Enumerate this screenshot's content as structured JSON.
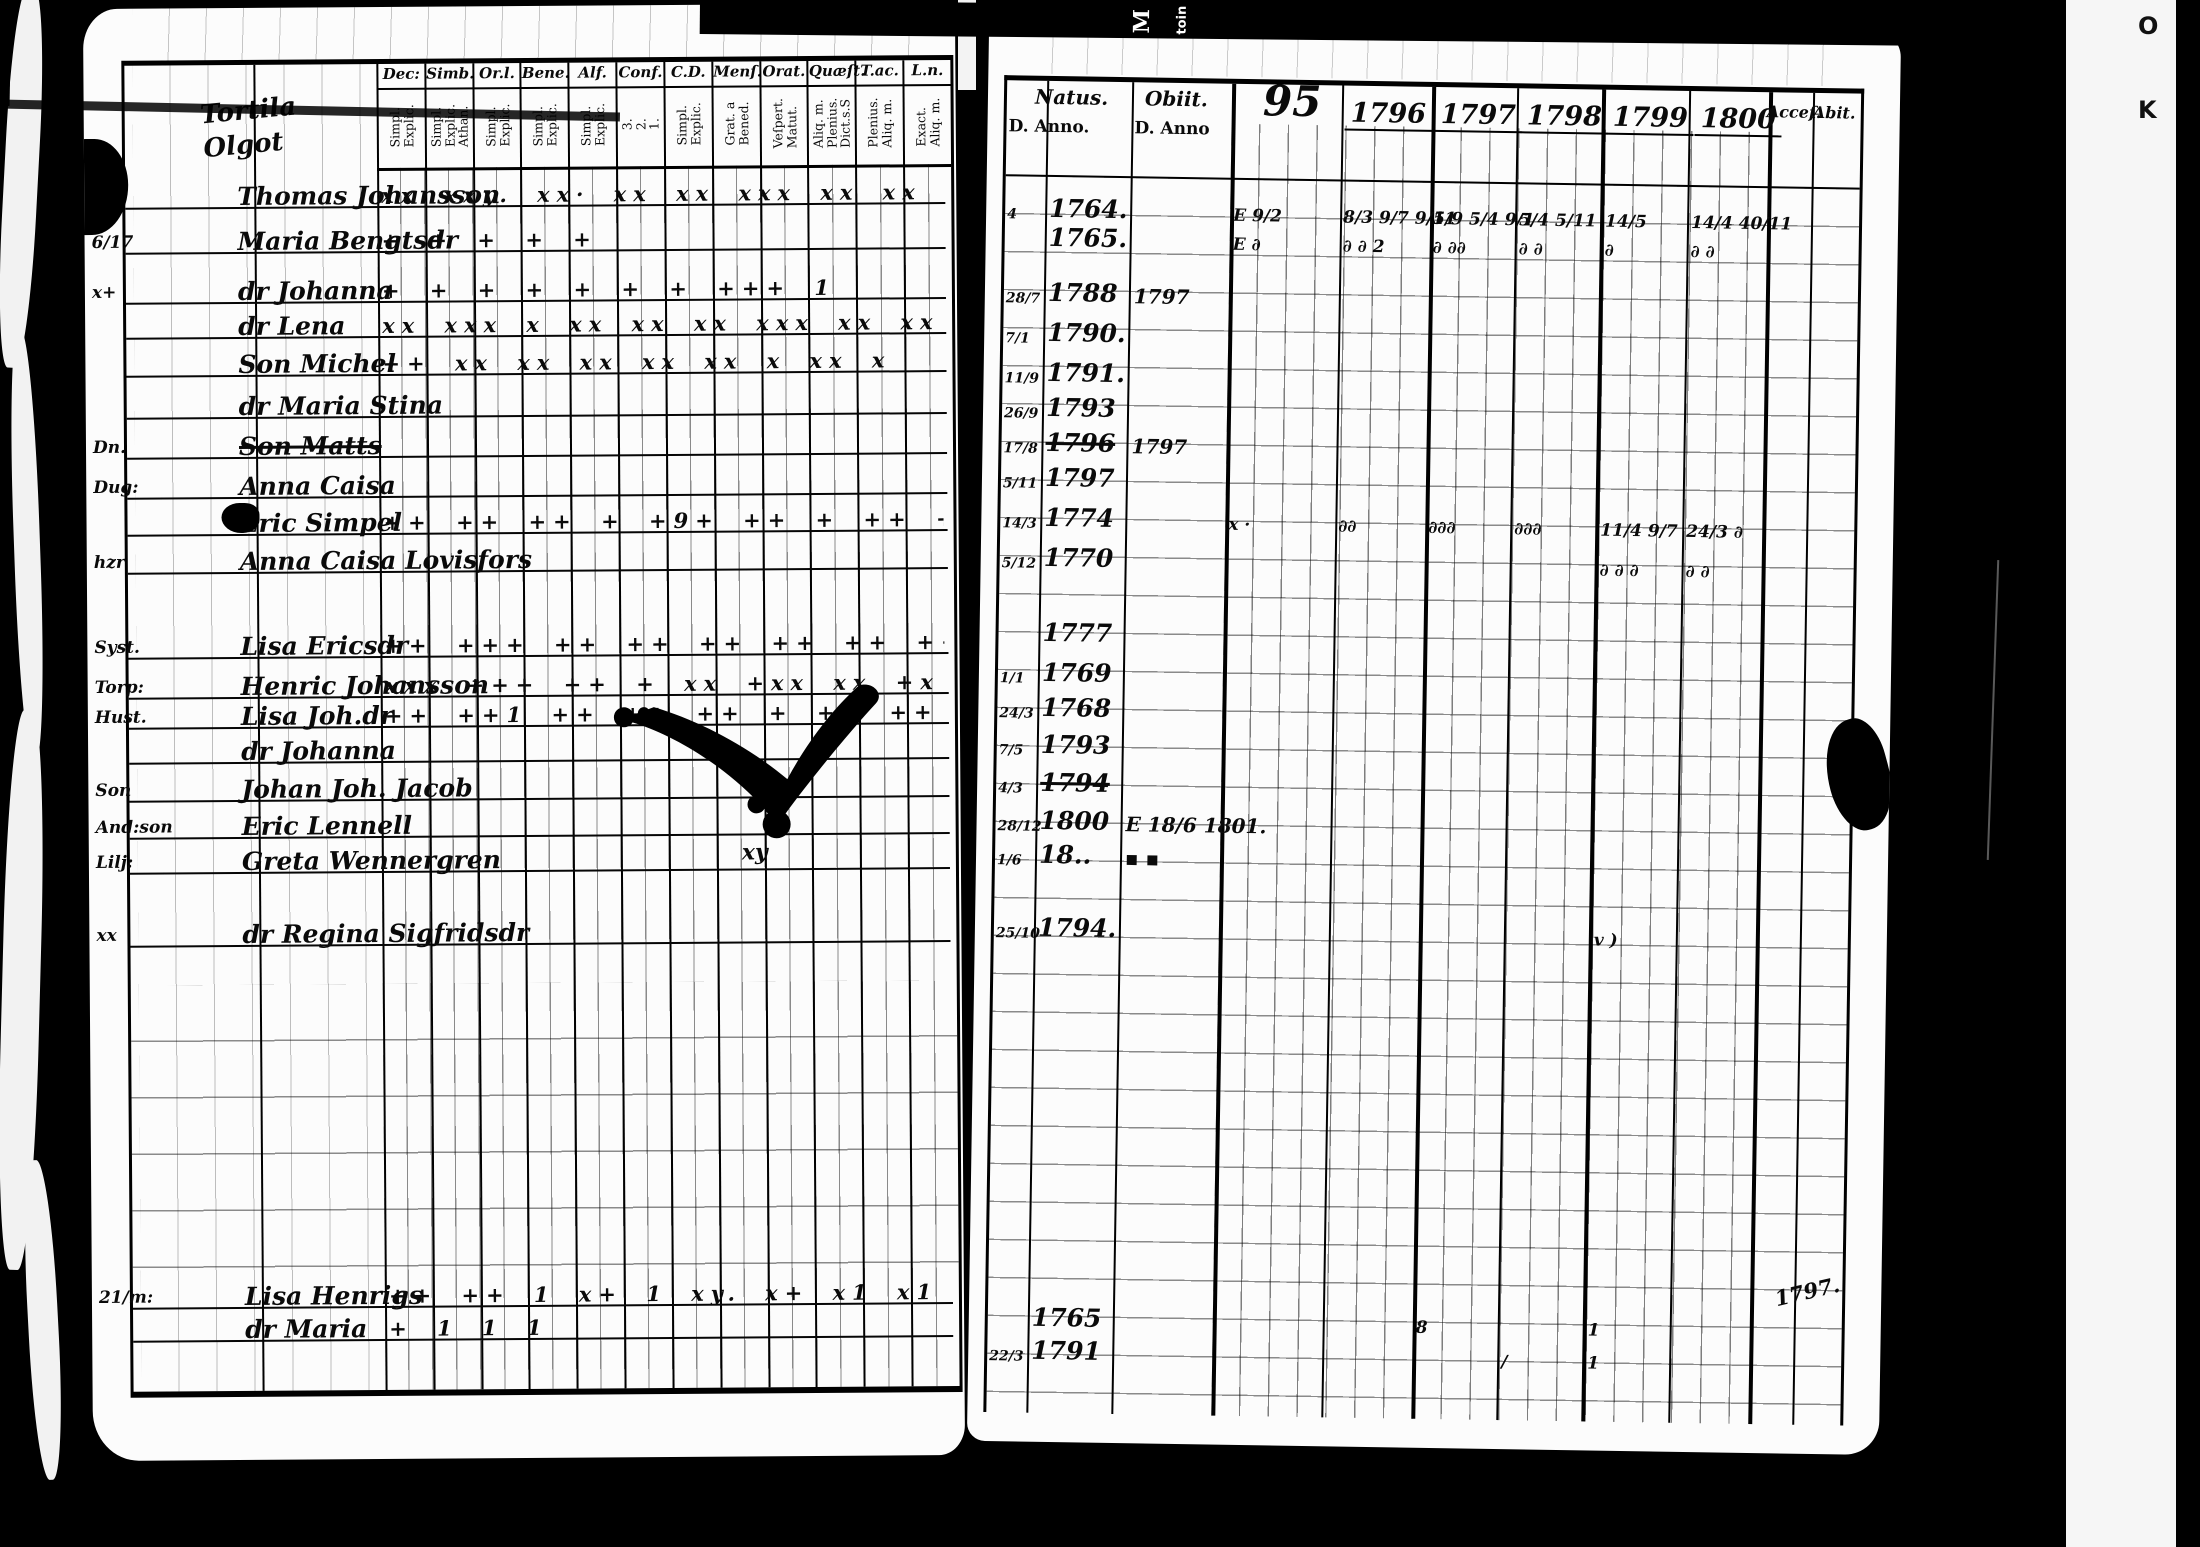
{
  "left_page": {
    "heading_line1": "Tortila",
    "heading_line2": "Olgot",
    "columns": [
      {
        "label": "Dec:",
        "subs": "Simpl.\nExplic."
      },
      {
        "label": "Simb.",
        "subs": "Simpl.\nExplic.\nAthan."
      },
      {
        "label": "Or.l.",
        "subs": "Simpl.\nExplic."
      },
      {
        "label": "Bene.",
        "subs": "Simpl.\nExplic."
      },
      {
        "label": "Alf.",
        "subs": "Simpl.\nExplic."
      },
      {
        "label": "Conf.",
        "subs": "3.\n2.\n1."
      },
      {
        "label": "C.D.",
        "subs": "Simpl.\nExplic."
      },
      {
        "label": "Menſ.",
        "subs": "Grat. a\nBened."
      },
      {
        "label": "Orat.",
        "subs": "Veſpert.\nMatut."
      },
      {
        "label": "Quæſt.",
        "subs": "Aliq. m.\nPlenius.\nDict.s.S"
      },
      {
        "label": "T.ac.",
        "subs": "Plenius.\nAliq. m."
      },
      {
        "label": "L.n.",
        "subs": "Exact.\nAliq. m."
      }
    ],
    "rows": [
      {
        "top": 112,
        "margin": "",
        "name": "Thomas Johansson",
        "marks": "xx xxy. xx· xx xx xxx xx xx xx xy. xx xI"
      },
      {
        "top": 157,
        "margin": "6/17",
        "name": "Maria Bengtsdr",
        "marks": "+ + + + +"
      },
      {
        "top": 207,
        "margin": "x+",
        "name": "dr Johanna",
        "marks": "+ + + + + + + +++  1"
      },
      {
        "top": 242,
        "margin": "",
        "name": "dr Lena",
        "marks": "xx xxx x xx xx xx xxx xx xx  xx x"
      },
      {
        "top": 280,
        "margin": "",
        "name": "Son Michel",
        "marks": "++ xx xx xx xx xx x xx  x"
      },
      {
        "top": 322,
        "margin": "",
        "name": "dr Maria Stina",
        "marks": ""
      },
      {
        "top": 362,
        "margin": "Dn.",
        "name": "Son Matts",
        "marks": "",
        "cls": "struck"
      },
      {
        "top": 402,
        "margin": "Dug:",
        "name": "Anna Caisa",
        "marks": ""
      },
      {
        "top": 439,
        "margin": "",
        "name": "Eric Simpel",
        "marks": "++ ++ ++ + +9+ ++ + ++ ++ + x +x  xx"
      },
      {
        "top": 477,
        "margin": "hzr",
        "name": "Anna Caisa Lovisfors",
        "marks": ""
      },
      {
        "top": 562,
        "margin": "Syst.",
        "name": "Lisa Ericsdr",
        "marks": "++ +++ ++ ++ ++ ++ ++ ++ ++ + xx + +1"
      },
      {
        "top": 602,
        "margin": "Torp:",
        "name": "Henric Johansson",
        "marks": "xxx +++ ++ + xx +xx xx +x +x +x + ++"
      },
      {
        "top": 632,
        "margin": "Hust.",
        "name": "Lisa Joh.dr",
        "marks": "++ ++1 ++ ++ ++ +  ++ ++ + ++ ++"
      },
      {
        "top": 667,
        "margin": "",
        "name": "dr Johanna",
        "marks": ""
      },
      {
        "top": 705,
        "margin": "Son",
        "name": "Johan Joh. Jacob",
        "marks": ""
      },
      {
        "top": 742,
        "margin": "And:son",
        "name": "Eric Lennell",
        "marks": ""
      },
      {
        "top": 777,
        "margin": "Lilj:",
        "name": "Greta Wennergren",
        "marks": ""
      },
      {
        "top": 850,
        "margin": "xx",
        "name": "dr Regina Sigfridsdr",
        "marks": ""
      },
      {
        "top": 1212,
        "margin": "21/m:",
        "name": "Lisa Henrigs",
        "marks": "++ ++ 1 x+ 1 xy. x+ x1 x1 x x"
      },
      {
        "top": 1245,
        "margin": "",
        "name": "dr Maria",
        "marks": "+ 1   1    1"
      }
    ],
    "xy_note": "xy"
  },
  "right_page": {
    "natus_label": "Natus.",
    "obiit_label": "Obiit.",
    "d_anno_left": "D. Anno.",
    "d_anno_right": "D. Anno",
    "acces_label": "Acceſ.",
    "abit_label": "Abit.",
    "years": [
      {
        "label": "95",
        "left": 250,
        "cls": "big"
      },
      {
        "label": "1796",
        "left": 338
      },
      {
        "label": "1797",
        "left": 428
      },
      {
        "label": "1798",
        "left": 514
      },
      {
        "label": "1799",
        "left": 600
      },
      {
        "label": "1800",
        "left": 688
      }
    ],
    "rows": [
      {
        "top": 110,
        "d": "4",
        "natus": "1764.",
        "obiit": "",
        "c95": "E 9/2",
        "c96": "8/3 9/7 9/11",
        "c97": "5/9 5/4 9/1",
        "c98": "5/4 5/11",
        "c99": "14/5",
        "c1800": "14/4 40/11"
      },
      {
        "top": 139,
        "d": "",
        "natus": "1765.",
        "obiit": "",
        "c95": "E ∂",
        "c96": "∂ ∂ 2",
        "c97": "∂ ∂∂",
        "c98": "∂ ∂",
        "c99": "∂",
        "c1800": "∂ ∂"
      },
      {
        "top": 194,
        "d": "28/7",
        "natus": "1788",
        "obiit": "1797"
      },
      {
        "top": 234,
        "d": "7/1",
        "natus": "1790."
      },
      {
        "top": 274,
        "d": "11/9",
        "natus": "1791."
      },
      {
        "top": 309,
        "d": "26/9",
        "natus": "1793"
      },
      {
        "top": 344,
        "d": "17/8",
        "natus": "1796",
        "obiit": "1797",
        "cls": "struck-n"
      },
      {
        "top": 379,
        "d": "5/11",
        "natus": "1797"
      },
      {
        "top": 419,
        "d": "14/3",
        "natus": "1774",
        "obiit": "",
        "c95": "x ·",
        "c96": "∂∂",
        "c97": "∂∂∂",
        "c98": "∂∂∂",
        "c99": "11/4 9/7",
        "c1800": "24/3 ∂"
      },
      {
        "top": 459,
        "d": "5/12",
        "natus": "1770",
        "obiit": "",
        "c99": "∂ ∂ ∂",
        "c1800": "∂ ∂"
      },
      {
        "top": 534,
        "d": "",
        "natus": "1777"
      },
      {
        "top": 574,
        "d": "1/1",
        "natus": "1769"
      },
      {
        "top": 609,
        "d": "24/3",
        "natus": "1768"
      },
      {
        "top": 646,
        "d": "7/5",
        "natus": "1793"
      },
      {
        "top": 684,
        "d": "4/3",
        "natus": "1794",
        "cls": "struck-n"
      },
      {
        "top": 722,
        "d": "28/12",
        "natus": "1800",
        "obiit": "E 18/6 1801."
      },
      {
        "top": 756,
        "d": "1/6",
        "natus": "18..",
        "obiit": "▪ ▪"
      },
      {
        "top": 829,
        "d": "25/10",
        "natus": "1794.",
        "obiit": "",
        "c99": "v )"
      },
      {
        "top": 1219,
        "d": "",
        "natus": "1765",
        "obiit": "",
        "c97": "8",
        "c99": "1"
      },
      {
        "top": 1252,
        "d": "22/3",
        "natus": "1791",
        "obiit": "",
        "c98": "/",
        "c99": "1"
      }
    ],
    "abit_note": "1797."
  },
  "artifacts": {
    "strip_text_1": "M",
    "strip_text_2": "toin",
    "edge_letter_top": "O",
    "edge_letter_bottom": "K"
  }
}
